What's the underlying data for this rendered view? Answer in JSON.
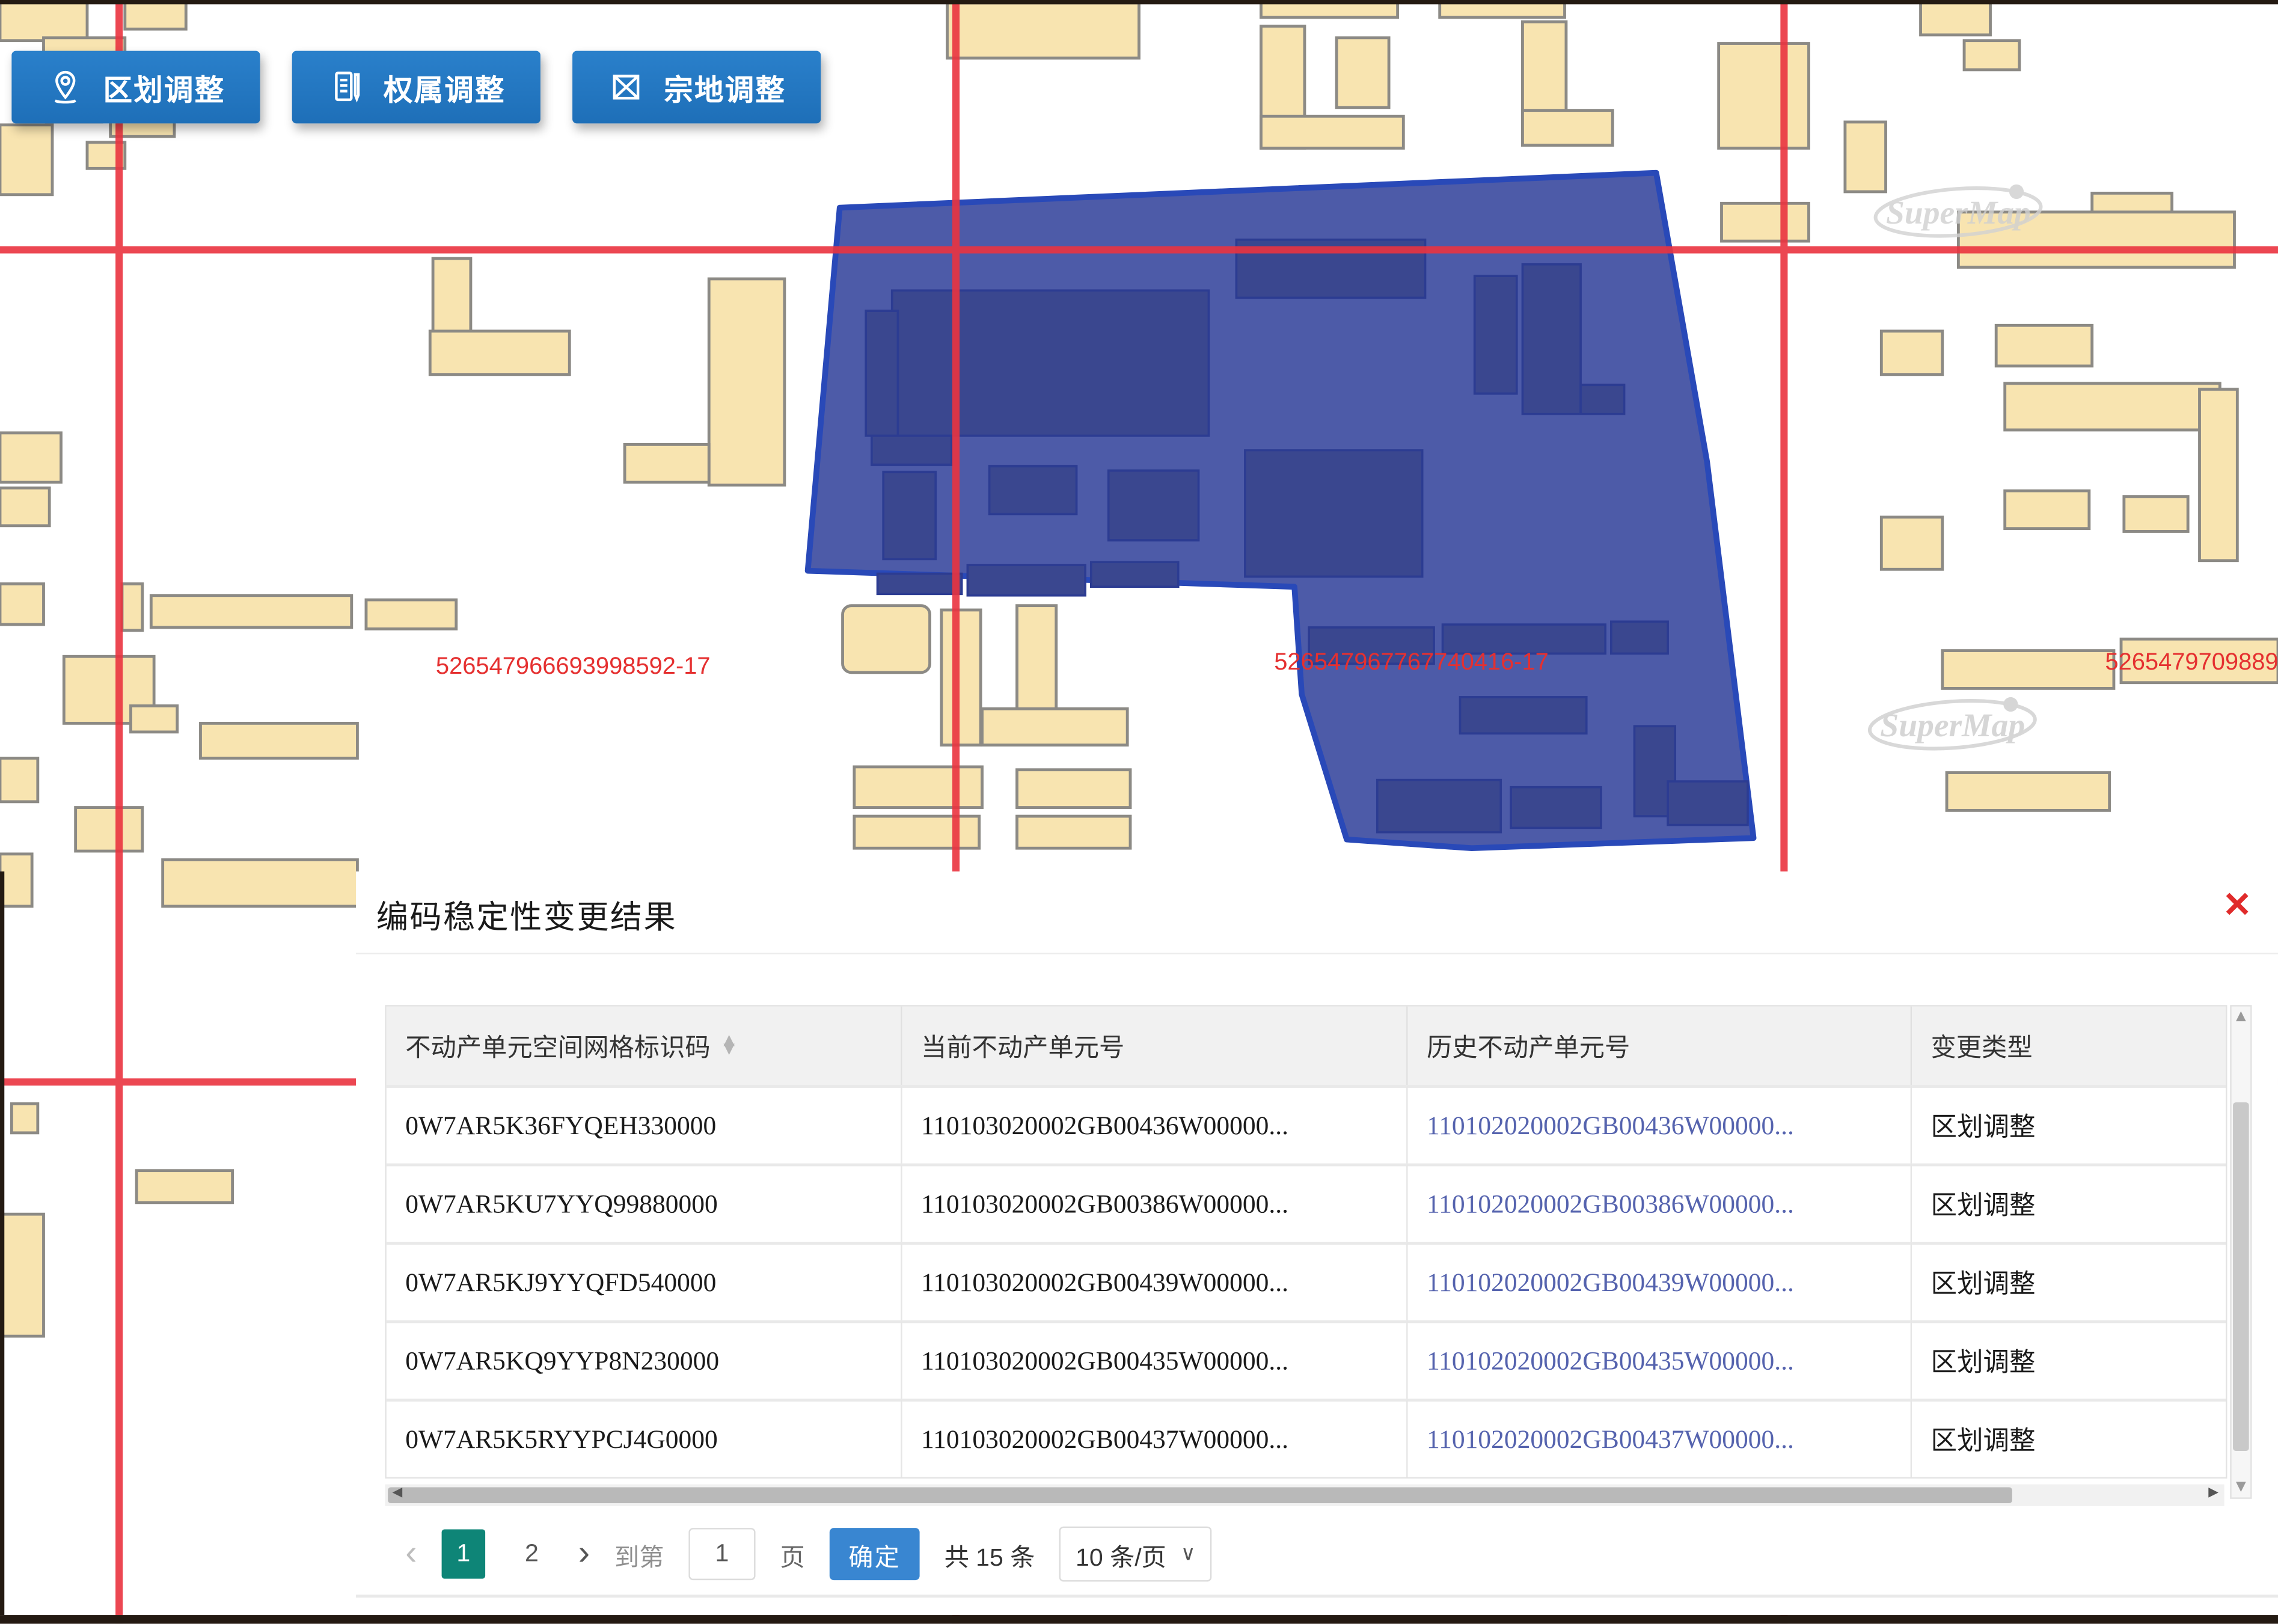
{
  "toolbar": {
    "buttons": [
      {
        "id": "district-adjust",
        "label": "区划调整"
      },
      {
        "id": "ownership-adjust",
        "label": "权属调整"
      },
      {
        "id": "parcel-adjust",
        "label": "宗地调整"
      }
    ]
  },
  "map": {
    "watermark": "SuperMap",
    "parcel_labels": [
      "526547966693998592-17",
      "526547967767740416-17",
      "5265479709889"
    ],
    "colors": {
      "selection_fill": "#4654a4",
      "selection_border": "#2949b8",
      "building_fill": "#f8e4b0",
      "building_border": "#8c8a85",
      "grid_line": "#ea3440",
      "label_red": "#e53030"
    }
  },
  "panel": {
    "title": "编码稳定性变更结果",
    "icons": {
      "close": "✕",
      "sort_asc": "▲",
      "sort_desc": "▼",
      "scroll_up": "▲",
      "scroll_down": "▼",
      "scroll_left": "◀",
      "scroll_right": "▶",
      "prev": "‹",
      "next": "›",
      "dropdown_caret": "∨"
    }
  },
  "table": {
    "headers": [
      "不动产单元空间网格标识码",
      "当前不动产单元号",
      "历史不动产单元号",
      "变更类型"
    ],
    "rows": [
      {
        "grid_code": "0W7AR5K36FYQEH330000",
        "current_unit": "110103020002GB00436W00000...",
        "history_unit": "110102020002GB00436W00000...",
        "change_type": "区划调整"
      },
      {
        "grid_code": "0W7AR5KU7YYQ99880000",
        "current_unit": "110103020002GB00386W00000...",
        "history_unit": "110102020002GB00386W00000...",
        "change_type": "区划调整"
      },
      {
        "grid_code": "0W7AR5KJ9YYQFD540000",
        "current_unit": "110103020002GB00439W00000...",
        "history_unit": "110102020002GB00439W00000...",
        "change_type": "区划调整"
      },
      {
        "grid_code": "0W7AR5KQ9YYP8N230000",
        "current_unit": "110103020002GB00435W00000...",
        "history_unit": "110102020002GB00435W00000...",
        "change_type": "区划调整"
      },
      {
        "grid_code": "0W7AR5K5RYYPCJ4G0000",
        "current_unit": "110103020002GB00437W00000...",
        "history_unit": "110102020002GB00437W00000...",
        "change_type": "区划调整"
      }
    ]
  },
  "pagination": {
    "pages": [
      "1",
      "2"
    ],
    "active_page": "1",
    "goto_label": "到第",
    "page_input": "1",
    "page_unit_label": "页",
    "confirm_label": "确定",
    "total_label": "共 15 条",
    "page_size_label": "10 条/页"
  }
}
